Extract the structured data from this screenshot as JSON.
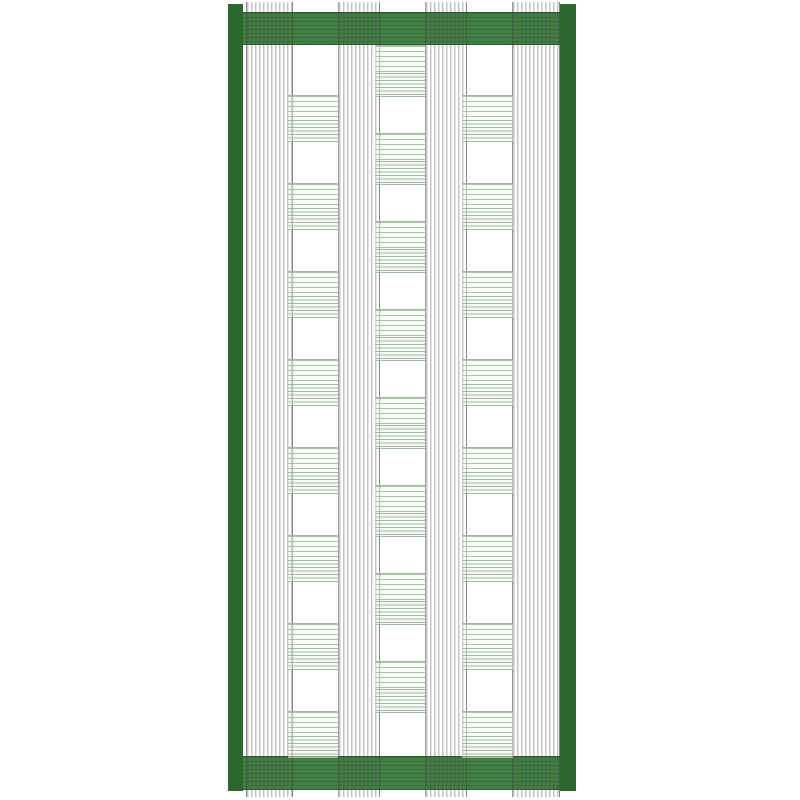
{
  "canvas": {
    "width": 800,
    "height": 800,
    "background": "#ffffff"
  },
  "colors": {
    "bar_green": "#2c672e",
    "band_green": "#3a7a3c",
    "band_edge": "#2a5c2c",
    "warp_line": "rgba(75,75,75,0.32)",
    "warp_edge": "rgba(70,70,70,0.50)",
    "weft_line": "#adc0ad",
    "weft_line_dense": "#a3b8a4",
    "weft_bg": "rgba(238,245,238,0.45)"
  },
  "frame": {
    "left_bar": {
      "x": 228,
      "y": 4,
      "width": 15,
      "height": 787
    },
    "right_bar": {
      "x": 560,
      "y": 4,
      "width": 16,
      "height": 787
    },
    "top_band": {
      "x": 243,
      "y": 12,
      "width": 317,
      "height": 31
    },
    "bottom_band": {
      "x": 243,
      "y": 756,
      "width": 317,
      "height": 32
    }
  },
  "warp": {
    "y_top": 2,
    "y_bottom": 797,
    "line_width": 1.6,
    "line_period": 4,
    "groups": [
      {
        "x": 246,
        "width": 45
      },
      {
        "x": 338,
        "width": 40
      },
      {
        "x": 425,
        "width": 40
      },
      {
        "x": 512,
        "width": 46
      }
    ]
  },
  "weft": {
    "row_step": 88,
    "line_period": 5,
    "dense_line_period": 3.5,
    "columns": [
      {
        "x": 288,
        "width": 50,
        "first_block_y": 95,
        "block_height": 45,
        "block_count": 8
      },
      {
        "x": 375,
        "width": 50,
        "first_block_y": 45,
        "block_height": 50,
        "block_count": 8
      },
      {
        "x": 462,
        "width": 51,
        "first_block_y": 95,
        "block_height": 45,
        "block_count": 8
      }
    ]
  }
}
